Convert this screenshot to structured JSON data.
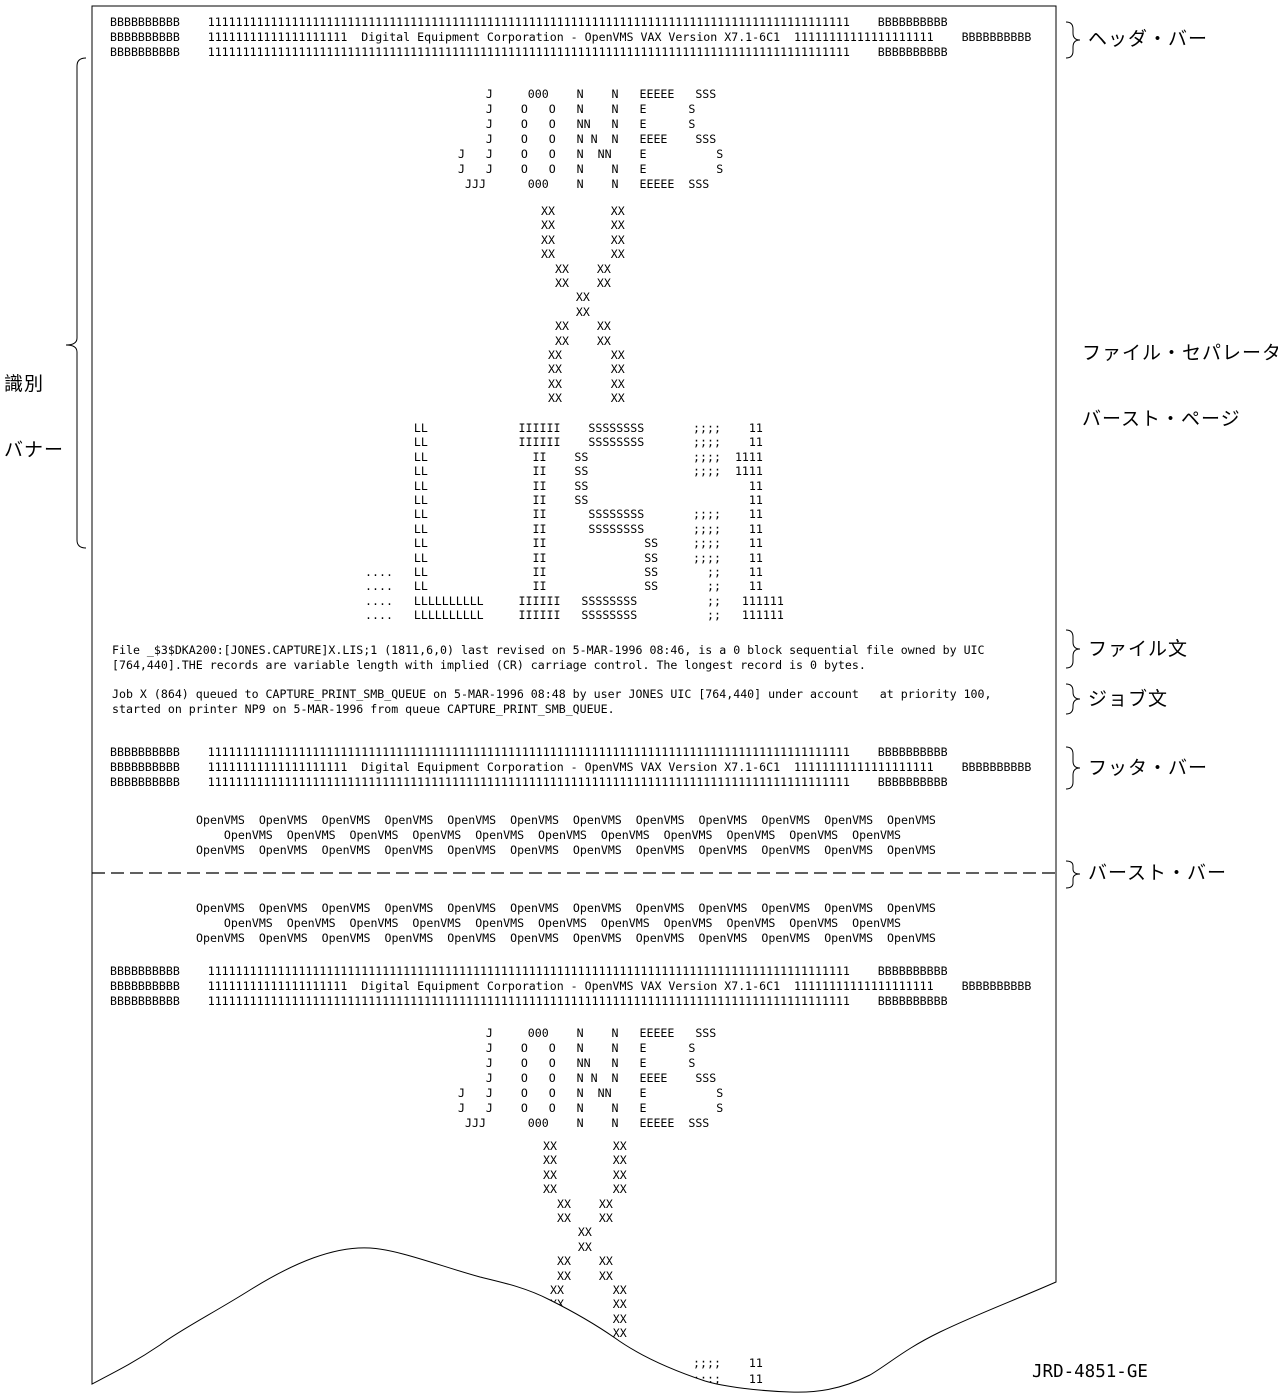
{
  "page": {
    "header_bar": {
      "lines": [
        "BBBBBBBBBB    11111111111111111111111111111111111111111111111111111111111111111111111111111111111111111111    BBBBBBBBBB",
        "BBBBBBBBBB    11111111111111111111  Digital Equipment Corporation - OpenVMS VAX Version X7.1-6C1  11111111111111111111    BBBBBBBBBB",
        "BBBBBBBBBB    11111111111111111111111111111111111111111111111111111111111111111111111111111111111111111111    BBBBBBBBBB"
      ]
    },
    "jones_art": {
      "lines": [
        "    J     000    N    N   EEEEE   SSS",
        "    J    O   O   N    N   E      S",
        "    J    O   O   NN   N   E      S",
        "    J    O   O   N N  N   EEEE    SSS",
        "J   J    O   O   N  NN    E          S",
        "J   J    O   O   N    N   E          S",
        " JJJ      000    N    N   EEEEE  SSS"
      ]
    },
    "x_art": {
      "lines": [
        "XX        XX",
        "XX        XX",
        "XX        XX",
        "XX        XX",
        "  XX    XX",
        "  XX    XX",
        "     XX",
        "     XX",
        "  XX    XX",
        "  XX    XX",
        " XX       XX",
        " XX       XX",
        " XX       XX",
        " XX       XX"
      ]
    },
    "lis_art": {
      "lines": [
        "       LL             IIIIII    SSSSSSSS       ;;;;    11",
        "       LL             IIIIII    SSSSSSSS       ;;;;    11",
        "       LL               II    SS               ;;;;  1111",
        "       LL               II    SS               ;;;;  1111",
        "       LL               II    SS                       11",
        "       LL               II    SS                       11",
        "       LL               II      SSSSSSSS       ;;;;    11",
        "       LL               II      SSSSSSSS       ;;;;    11",
        "       LL               II              SS     ;;;;    11",
        "       LL               II              SS     ;;;;    11",
        "....   LL               II              SS       ;;    11",
        "....   LL               II              SS       ;;    11",
        "....   LLLLLLLLLL     IIIIII   SSSSSSSS          ;;   111111",
        "....   LLLLLLLLLL     IIIIII   SSSSSSSS          ;;   111111"
      ]
    },
    "file_text": {
      "lines": [
        "File _$3$DKA200:[JONES.CAPTURE]X.LIS;1 (1811,6,0) last revised on 5-MAR-1996 08:46, is a 0 block sequential file owned by UIC",
        "[764,440].THE records are variable length with implied (CR) carriage control. The longest record is 0 bytes."
      ]
    },
    "job_text": {
      "lines": [
        "Job X (864) queued to CAPTURE_PRINT_SMB_QUEUE on 5-MAR-1996 08:48 by user JONES UIC [764,440] under account   at priority 100,",
        "started on printer NP9 on 5-MAR-1996 from queue CAPTURE_PRINT_SMB_QUEUE."
      ]
    },
    "footer_bar": {
      "lines": [
        "BBBBBBBBBB    11111111111111111111111111111111111111111111111111111111111111111111111111111111111111111111    BBBBBBBBBB",
        "BBBBBBBBBB    11111111111111111111  Digital Equipment Corporation - OpenVMS VAX Version X7.1-6C1  11111111111111111111    BBBBBBBBBB",
        "BBBBBBBBBB    11111111111111111111111111111111111111111111111111111111111111111111111111111111111111111111    BBBBBBBBBB"
      ]
    },
    "openvms_trailer_top": {
      "lines": [
        "OpenVMS  OpenVMS  OpenVMS  OpenVMS  OpenVMS  OpenVMS  OpenVMS  OpenVMS  OpenVMS  OpenVMS  OpenVMS  OpenVMS",
        "    OpenVMS  OpenVMS  OpenVMS  OpenVMS  OpenVMS  OpenVMS  OpenVMS  OpenVMS  OpenVMS  OpenVMS  OpenVMS",
        "OpenVMS  OpenVMS  OpenVMS  OpenVMS  OpenVMS  OpenVMS  OpenVMS  OpenVMS  OpenVMS  OpenVMS  OpenVMS  OpenVMS"
      ]
    },
    "openvms_trailer_bottom": {
      "lines": [
        "OpenVMS  OpenVMS  OpenVMS  OpenVMS  OpenVMS  OpenVMS  OpenVMS  OpenVMS  OpenVMS  OpenVMS  OpenVMS  OpenVMS",
        "    OpenVMS  OpenVMS  OpenVMS  OpenVMS  OpenVMS  OpenVMS  OpenVMS  OpenVMS  OpenVMS  OpenVMS  OpenVMS",
        "OpenVMS  OpenVMS  OpenVMS  OpenVMS  OpenVMS  OpenVMS  OpenVMS  OpenVMS  OpenVMS  OpenVMS  OpenVMS  OpenVMS"
      ]
    },
    "second_header_bar": {
      "lines": [
        "BBBBBBBBBB    11111111111111111111111111111111111111111111111111111111111111111111111111111111111111111111    BBBBBBBBBB",
        "BBBBBBBBBB    11111111111111111111  Digital Equipment Corporation - OpenVMS VAX Version X7.1-6C1  11111111111111111111    BBBBBBBBBB",
        "BBBBBBBBBB    11111111111111111111111111111111111111111111111111111111111111111111111111111111111111111111    BBBBBBBBBB"
      ]
    },
    "second_jones_art": {
      "lines": [
        "    J     000    N    N   EEEEE   SSS",
        "    J    O   O   N    N   E      S",
        "    J    O   O   NN   N   E      S",
        "    J    O   O   N N  N   EEEE    SSS",
        "J   J    O   O   N  NN    E          S",
        "J   J    O   O   N    N   E          S",
        " JJJ      000    N    N   EEEEE  SSS"
      ]
    },
    "second_x_art": {
      "lines": [
        "XX        XX",
        "XX        XX",
        "XX        XX",
        "XX        XX",
        "  XX    XX",
        "  XX    XX",
        "     XX",
        "     XX",
        "  XX    XX",
        "  XX    XX",
        " XX       XX",
        " XX       XX",
        " XX       XX",
        " XX       XX"
      ]
    },
    "second_lis_art_partial": {
      "lines": [
        "       LL             IIIIII    SSSSSSSS       ;;;;    11",
        "       LL             IIIIII    SSSSSSSS       ;;;;    11"
      ]
    }
  },
  "labels": {
    "identification_banner_line1": "識別",
    "identification_banner_line2": "バナー",
    "header_bar": "ヘッダ・バー",
    "file_separator_line1": "ファイル・セパレータ",
    "file_separator_line2": "バースト・ページ",
    "file_text": "ファイル文",
    "job_text": "ジョブ文",
    "footer_bar": "フッタ・バー",
    "burst_bar": "バースト・バー",
    "figure_id": "JRD-4851-GE"
  },
  "colors": {
    "ink": "#000000",
    "paper": "#ffffff"
  }
}
